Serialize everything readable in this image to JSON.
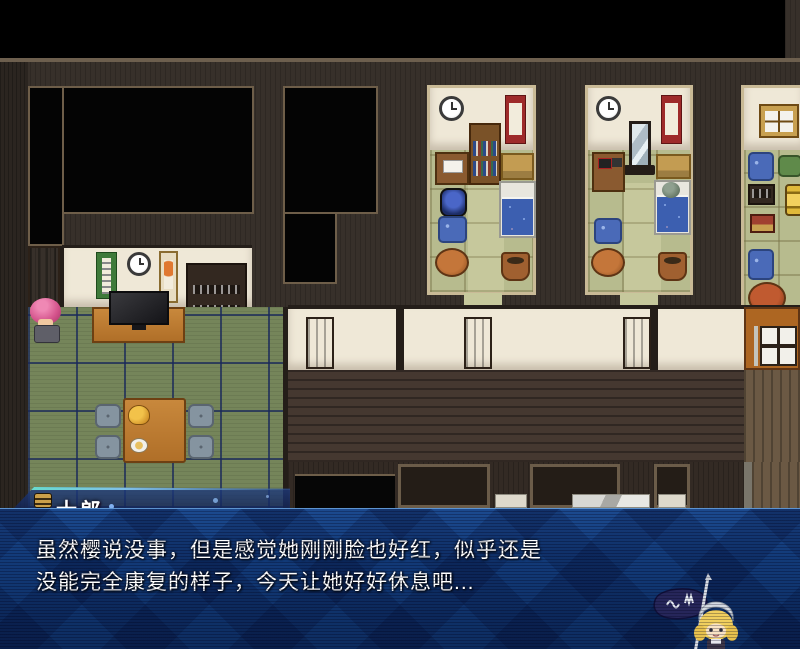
{
  "dialog": {
    "speaker": "士郎",
    "lines": [
      "虽然樱说没事，但是感觉她刚刚脸也好红，似乎还是",
      "没能完全康复的样子，今天让她好好休息吧..."
    ]
  },
  "colors": {
    "dialog_top": "#1c4a8f",
    "dialog_bottom": "#0d2c5f",
    "banner_edge": "#7fc0ea",
    "wall_wood": "#37302a",
    "tatami_living": "#75855a",
    "tatami_bedroom": "#b7bb8e",
    "white_wall": "#efe8d7",
    "furniture_wood": "#c07a32",
    "bed_blanket": "#3c5fb0",
    "text": "#ffffff"
  },
  "objects": [
    "wall-clock",
    "hanging-scroll",
    "bookshelf",
    "desk",
    "bed",
    "mirror",
    "floor-cushion",
    "round-table",
    "potted-plant",
    "tv",
    "bar-cabinet",
    "low-table",
    "duck-ornament",
    "shoji-screen",
    "door",
    "player-character",
    "sleeping-character",
    "chibi-flag-bearer"
  ]
}
